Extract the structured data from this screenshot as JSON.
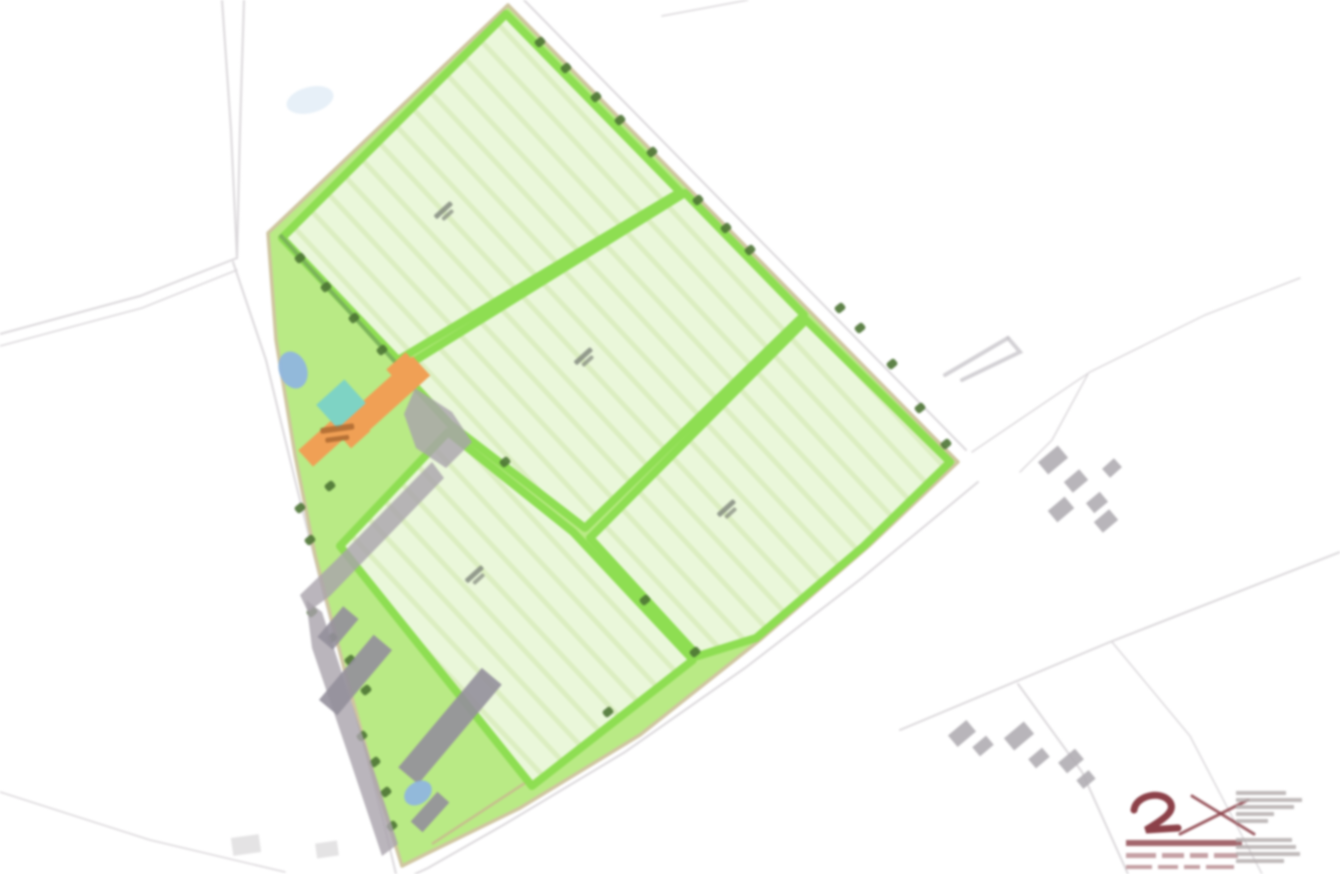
{
  "canvas": {
    "width": 1340,
    "height": 874,
    "background": "#ffffff"
  },
  "palette": {
    "field_fill": "#eaf7da",
    "field_stripe": "#cfe8ad",
    "hedge_green": "#8ede52",
    "paddock_green": "#b9ea85",
    "boundary_tan": "#cfc5a0",
    "road_gray": "#dbd8db",
    "track_tan": "#c9b98f",
    "tree_dark": "#4c7434",
    "treeline_green": "#7ab05a",
    "orange_building": "#f0a055",
    "courtyard_teal": "#7ed3c4",
    "pond_blue": "#8fb6de",
    "pond_faint": "#d7e6f4",
    "yard_gray": "#a9a3ab",
    "barn_gray": "#948f9b",
    "house_gray": "#b0adb2",
    "house_faint": "#d2d0d2",
    "label_gray": "#7d8379",
    "farm_label_brown": "#a8652e",
    "logo_maroon": "#8c4149",
    "logo_text_gray": "#b5aeae",
    "arrow_gray": "#c8c6ca"
  },
  "roads": [
    {
      "pts": [
        [
          222,
          0
        ],
        [
          231,
          130
        ],
        [
          237,
          258
        ]
      ],
      "w": 2
    },
    {
      "pts": [
        [
          244,
          0
        ],
        [
          240,
          130
        ],
        [
          237,
          258
        ]
      ],
      "w": 2
    },
    {
      "pts": [
        [
          237,
          258
        ],
        [
          140,
          296
        ],
        [
          0,
          334
        ]
      ],
      "w": 2
    },
    {
      "pts": [
        [
          237,
          270
        ],
        [
          142,
          308
        ],
        [
          0,
          346
        ]
      ],
      "w": 1.5
    },
    {
      "pts": [
        [
          233,
          262
        ],
        [
          266,
          360
        ],
        [
          295,
          480
        ],
        [
          325,
          600
        ],
        [
          355,
          710
        ],
        [
          383,
          820
        ],
        [
          396,
          874
        ]
      ],
      "w": 2
    },
    {
      "pts": [
        [
          978,
          482
        ],
        [
          862,
          578
        ],
        [
          745,
          668
        ],
        [
          625,
          752
        ],
        [
          505,
          824
        ],
        [
          428,
          868
        ],
        [
          415,
          874
        ]
      ],
      "w": 2
    },
    {
      "pts": [
        [
          524,
          0
        ],
        [
          744,
          224
        ],
        [
          966,
          450
        ]
      ],
      "w": 2
    },
    {
      "pts": [
        [
          972,
          452
        ],
        [
          1090,
          372
        ],
        [
          1205,
          315
        ],
        [
          1300,
          278
        ]
      ],
      "w": 1.5
    },
    {
      "pts": [
        [
          1088,
          374
        ],
        [
          1052,
          440
        ],
        [
          1020,
          472
        ]
      ],
      "w": 1.5
    },
    {
      "pts": [
        [
          900,
          730
        ],
        [
          1110,
          642
        ],
        [
          1340,
          552
        ]
      ],
      "w": 2
    },
    {
      "pts": [
        [
          1018,
          684
        ],
        [
          1082,
          772
        ],
        [
          1128,
          874
        ]
      ],
      "w": 2
    },
    {
      "pts": [
        [
          1112,
          642
        ],
        [
          1190,
          736
        ],
        [
          1262,
          874
        ]
      ],
      "w": 1.5
    },
    {
      "pts": [
        [
          662,
          16
        ],
        [
          748,
          0
        ]
      ],
      "w": 1.5
    },
    {
      "pts": [
        [
          0,
          792
        ],
        [
          150,
          840
        ],
        [
          285,
          872
        ]
      ],
      "w": 1.5
    }
  ],
  "site": {
    "outline": [
      [
        268,
        233
      ],
      [
        508,
        5
      ],
      [
        958,
        462
      ],
      [
        870,
        545
      ],
      [
        760,
        640
      ],
      [
        640,
        735
      ],
      [
        520,
        808
      ],
      [
        430,
        852
      ],
      [
        402,
        866
      ],
      [
        372,
        770
      ],
      [
        345,
        672
      ],
      [
        315,
        555
      ],
      [
        295,
        455
      ],
      [
        276,
        340
      ]
    ],
    "track_line": [
      [
        432,
        844
      ],
      [
        560,
        760
      ],
      [
        698,
        658
      ]
    ]
  },
  "fields": [
    {
      "id": "field-1",
      "outline": [
        [
          282,
          238
        ],
        [
          506,
          14
        ],
        [
          680,
          192
        ],
        [
          398,
          360
        ]
      ],
      "label_pos": [
        445,
        212
      ]
    },
    {
      "id": "field-2",
      "outline": [
        [
          400,
          370
        ],
        [
          685,
          193
        ],
        [
          804,
          315
        ],
        [
          585,
          528
        ],
        [
          450,
          424
        ]
      ],
      "label_pos": [
        585,
        358
      ]
    },
    {
      "id": "field-3",
      "outline": [
        [
          590,
          538
        ],
        [
          806,
          320
        ],
        [
          950,
          462
        ],
        [
          864,
          546
        ],
        [
          756,
          638
        ],
        [
          698,
          656
        ]
      ],
      "label_pos": [
        728,
        510
      ]
    },
    {
      "id": "field-4",
      "outline": [
        [
          448,
          432
        ],
        [
          573,
          532
        ],
        [
          693,
          660
        ],
        [
          532,
          786
        ],
        [
          340,
          546
        ]
      ],
      "label_pos": [
        476,
        576
      ]
    }
  ],
  "treeline": {
    "from": [
      280,
      235
    ],
    "to": [
      396,
      363
    ],
    "trees": [
      [
        300,
        258
      ],
      [
        326,
        287
      ],
      [
        354,
        318
      ],
      [
        382,
        350
      ]
    ]
  },
  "boundary_trees": [
    [
      540,
      42
    ],
    [
      566,
      68
    ],
    [
      596,
      97
    ],
    [
      620,
      120
    ],
    [
      652,
      152
    ],
    [
      698,
      200
    ],
    [
      726,
      228
    ],
    [
      750,
      250
    ],
    [
      840,
      308
    ],
    [
      860,
      328
    ],
    [
      892,
      364
    ],
    [
      920,
      408
    ],
    [
      946,
      444
    ]
  ],
  "scatter_trees": [
    [
      505,
      462
    ],
    [
      645,
      600
    ],
    [
      695,
      652
    ],
    [
      608,
      712
    ],
    [
      300,
      508
    ],
    [
      310,
      540
    ],
    [
      312,
      612
    ],
    [
      332,
      638
    ],
    [
      350,
      660
    ],
    [
      366,
      690
    ],
    [
      362,
      736
    ],
    [
      375,
      762
    ],
    [
      386,
      792
    ],
    [
      392,
      826
    ],
    [
      330,
      486
    ]
  ],
  "farm": {
    "orange_buildings": [
      {
        "x": 330,
        "y": 388,
        "w": 105,
        "h": 26,
        "rot": -42
      },
      {
        "x": 393,
        "y": 357,
        "w": 26,
        "h": 30,
        "rot": -42
      },
      {
        "x": 339,
        "y": 417,
        "w": 26,
        "h": 26,
        "rot": -42
      },
      {
        "x": 299,
        "y": 430,
        "w": 52,
        "h": 22,
        "rot": -42
      }
    ],
    "courtyard": {
      "x": 322,
      "y": 388,
      "w": 38,
      "h": 32,
      "rot": -42
    },
    "yards": [
      [
        [
          415,
          388
        ],
        [
          452,
          412
        ],
        [
          472,
          442
        ],
        [
          446,
          468
        ],
        [
          416,
          448
        ],
        [
          404,
          414
        ]
      ],
      [
        [
          432,
          462
        ],
        [
          444,
          478
        ],
        [
          330,
          596
        ],
        [
          308,
          612
        ],
        [
          300,
          595
        ],
        [
          336,
          560
        ]
      ],
      [
        [
          306,
          600
        ],
        [
          322,
          612
        ],
        [
          398,
          844
        ],
        [
          382,
          856
        ],
        [
          350,
          760
        ],
        [
          312,
          648
        ]
      ]
    ],
    "barns": [
      {
        "x": 385,
        "y": 713,
        "w": 130,
        "h": 26,
        "rot": -50
      },
      {
        "x": 313,
        "y": 663,
        "w": 85,
        "h": 24,
        "rot": -50
      },
      {
        "x": 318,
        "y": 618,
        "w": 40,
        "h": 20,
        "rot": -50
      },
      {
        "x": 410,
        "y": 804,
        "w": 40,
        "h": 16,
        "rot": -48
      }
    ],
    "label_bars": [
      {
        "x": 320,
        "y": 428,
        "w": 34,
        "h": 6,
        "rot": -8
      },
      {
        "x": 325,
        "y": 438,
        "w": 24,
        "h": 5,
        "rot": -8
      }
    ]
  },
  "ponds": [
    {
      "cx": 293,
      "cy": 370,
      "rx": 14,
      "ry": 19,
      "rot": -20,
      "faint": false
    },
    {
      "cx": 418,
      "cy": 793,
      "rx": 15,
      "ry": 11,
      "rot": -35,
      "faint": false
    },
    {
      "cx": 310,
      "cy": 100,
      "rx": 24,
      "ry": 13,
      "rot": -15,
      "faint": true
    }
  ],
  "houses_mid": [
    {
      "x": 1040,
      "y": 452,
      "w": 26,
      "h": 16,
      "rot": -40
    },
    {
      "x": 1066,
      "y": 474,
      "w": 20,
      "h": 14,
      "rot": -40
    },
    {
      "x": 1050,
      "y": 502,
      "w": 22,
      "h": 15,
      "rot": -40
    },
    {
      "x": 1088,
      "y": 496,
      "w": 18,
      "h": 13,
      "rot": -40
    },
    {
      "x": 1104,
      "y": 462,
      "w": 16,
      "h": 12,
      "rot": -42
    },
    {
      "x": 1096,
      "y": 514,
      "w": 20,
      "h": 14,
      "rot": -40
    }
  ],
  "houses_bottom": [
    {
      "x": 950,
      "y": 726,
      "w": 24,
      "h": 15,
      "rot": -40
    },
    {
      "x": 974,
      "y": 740,
      "w": 18,
      "h": 12,
      "rot": -40
    },
    {
      "x": 1006,
      "y": 728,
      "w": 26,
      "h": 16,
      "rot": -40
    },
    {
      "x": 1030,
      "y": 752,
      "w": 18,
      "h": 12,
      "rot": -40
    },
    {
      "x": 1060,
      "y": 754,
      "w": 22,
      "h": 14,
      "rot": -40
    },
    {
      "x": 1078,
      "y": 774,
      "w": 16,
      "h": 11,
      "rot": -40
    }
  ],
  "houses_faint": [
    {
      "x": 232,
      "y": 836,
      "w": 28,
      "h": 18,
      "rot": -8
    },
    {
      "x": 316,
      "y": 842,
      "w": 22,
      "h": 15,
      "rot": -8
    }
  ],
  "marker": {
    "lines": [
      [
        [
          945,
          375
        ],
        [
          1008,
          338
        ]
      ],
      [
        [
          1008,
          338
        ],
        [
          1020,
          352
        ],
        [
          962,
          380
        ]
      ]
    ]
  },
  "logo": {
    "glyph_path": "M1134 810 C1136 795 1162 790 1170 802 C1176 812 1162 820 1146 830 L1178 828",
    "cross_lines": [
      [
        [
          1180,
          834
        ],
        [
          1248,
          800
        ]
      ],
      [
        [
          1192,
          796
        ],
        [
          1254,
          834
        ]
      ]
    ],
    "bar": {
      "x": 1126,
      "y": 840,
      "w": 116,
      "h": 6
    },
    "dash_rows": [
      {
        "y": 853,
        "h": 5,
        "xs": [
          1126,
          1162,
          1190,
          1214
        ],
        "ws": [
          30,
          22,
          18,
          24
        ]
      },
      {
        "y": 865,
        "h": 4,
        "xs": [
          1126,
          1158,
          1184,
          1206
        ],
        "ws": [
          26,
          20,
          16,
          28
        ]
      }
    ],
    "text_col": {
      "x": 1236,
      "top": {
        "ys": [
          791,
          798,
          805,
          812,
          819
        ],
        "ws": [
          50,
          66,
          58,
          38,
          32
        ],
        "h": 4
      },
      "bottom": {
        "ys": [
          838,
          845,
          852,
          859
        ],
        "ws": [
          56,
          60,
          64,
          48
        ],
        "h": 4
      }
    }
  },
  "field_label_bar": {
    "w1": 22,
    "h1": 5,
    "w2": 14,
    "h2": 4,
    "rot": -42
  },
  "hatch": {
    "angle": 47,
    "spacing": 24,
    "line_w": 5
  }
}
